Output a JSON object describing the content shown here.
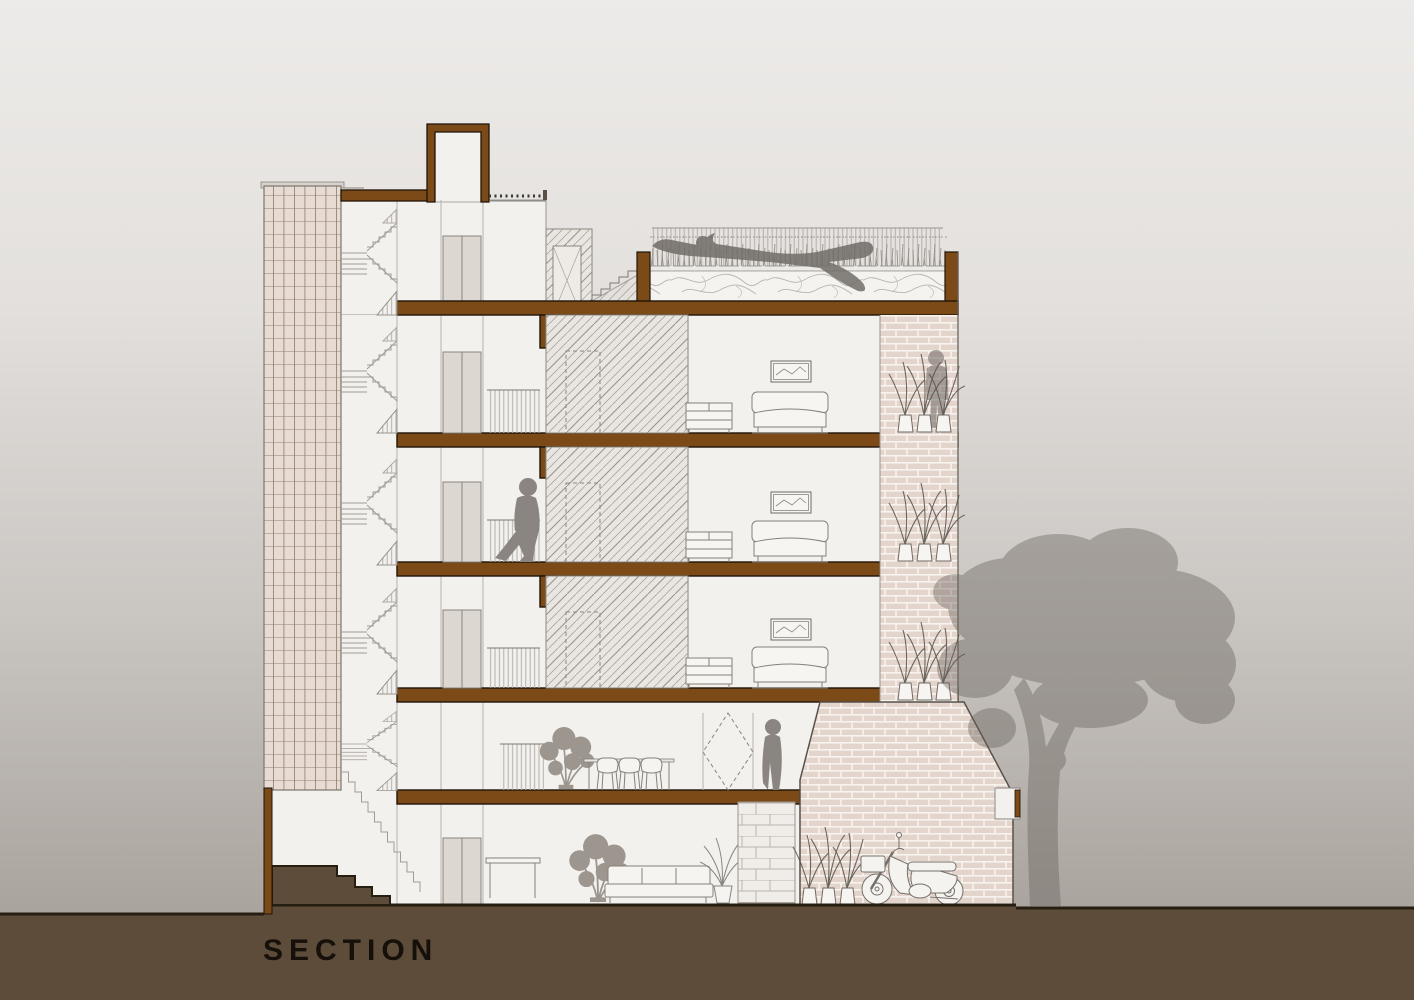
{
  "title": {
    "label": "SECTION"
  },
  "drawing": {
    "kind": "architectural-building-section",
    "depicted_elements": [
      "rooftop-pool",
      "swimmer",
      "pool-fence",
      "roof-grass",
      "elevator-shaft",
      "stair-core",
      "lattice-screen-tower",
      "bedroom-with-bed",
      "picture-frame",
      "cabinet",
      "balcony-plants",
      "standing-man",
      "walking-man",
      "dining-table",
      "chairs",
      "standing-woman",
      "monstera-plant",
      "sofa",
      "palm-plant",
      "stone-wall",
      "brick-front-house",
      "motorcycle",
      "yard-plants",
      "tree",
      "ground",
      "entry-steps"
    ]
  },
  "palette": {
    "background_top": "#edebe9",
    "background_bottom": "#a29c96",
    "ground_brown": "#5d4c39",
    "ground_edge_dark": "#271e12",
    "slab_brown": "#7c4a16",
    "slab_edge_dark": "#1f1409",
    "wall_white": "#f3f1ee",
    "lattice_pink": "#e7dbd3",
    "lattice_line": "#93826f",
    "brick_pink": "#e3d4cc",
    "brick_mortar": "#f7f3ef",
    "hatch_line": "#aba49d",
    "water_line": "#bab5af",
    "figure_gray": "#8a8580",
    "tree_gray": "#655f59",
    "outline_gray": "#85807a"
  }
}
